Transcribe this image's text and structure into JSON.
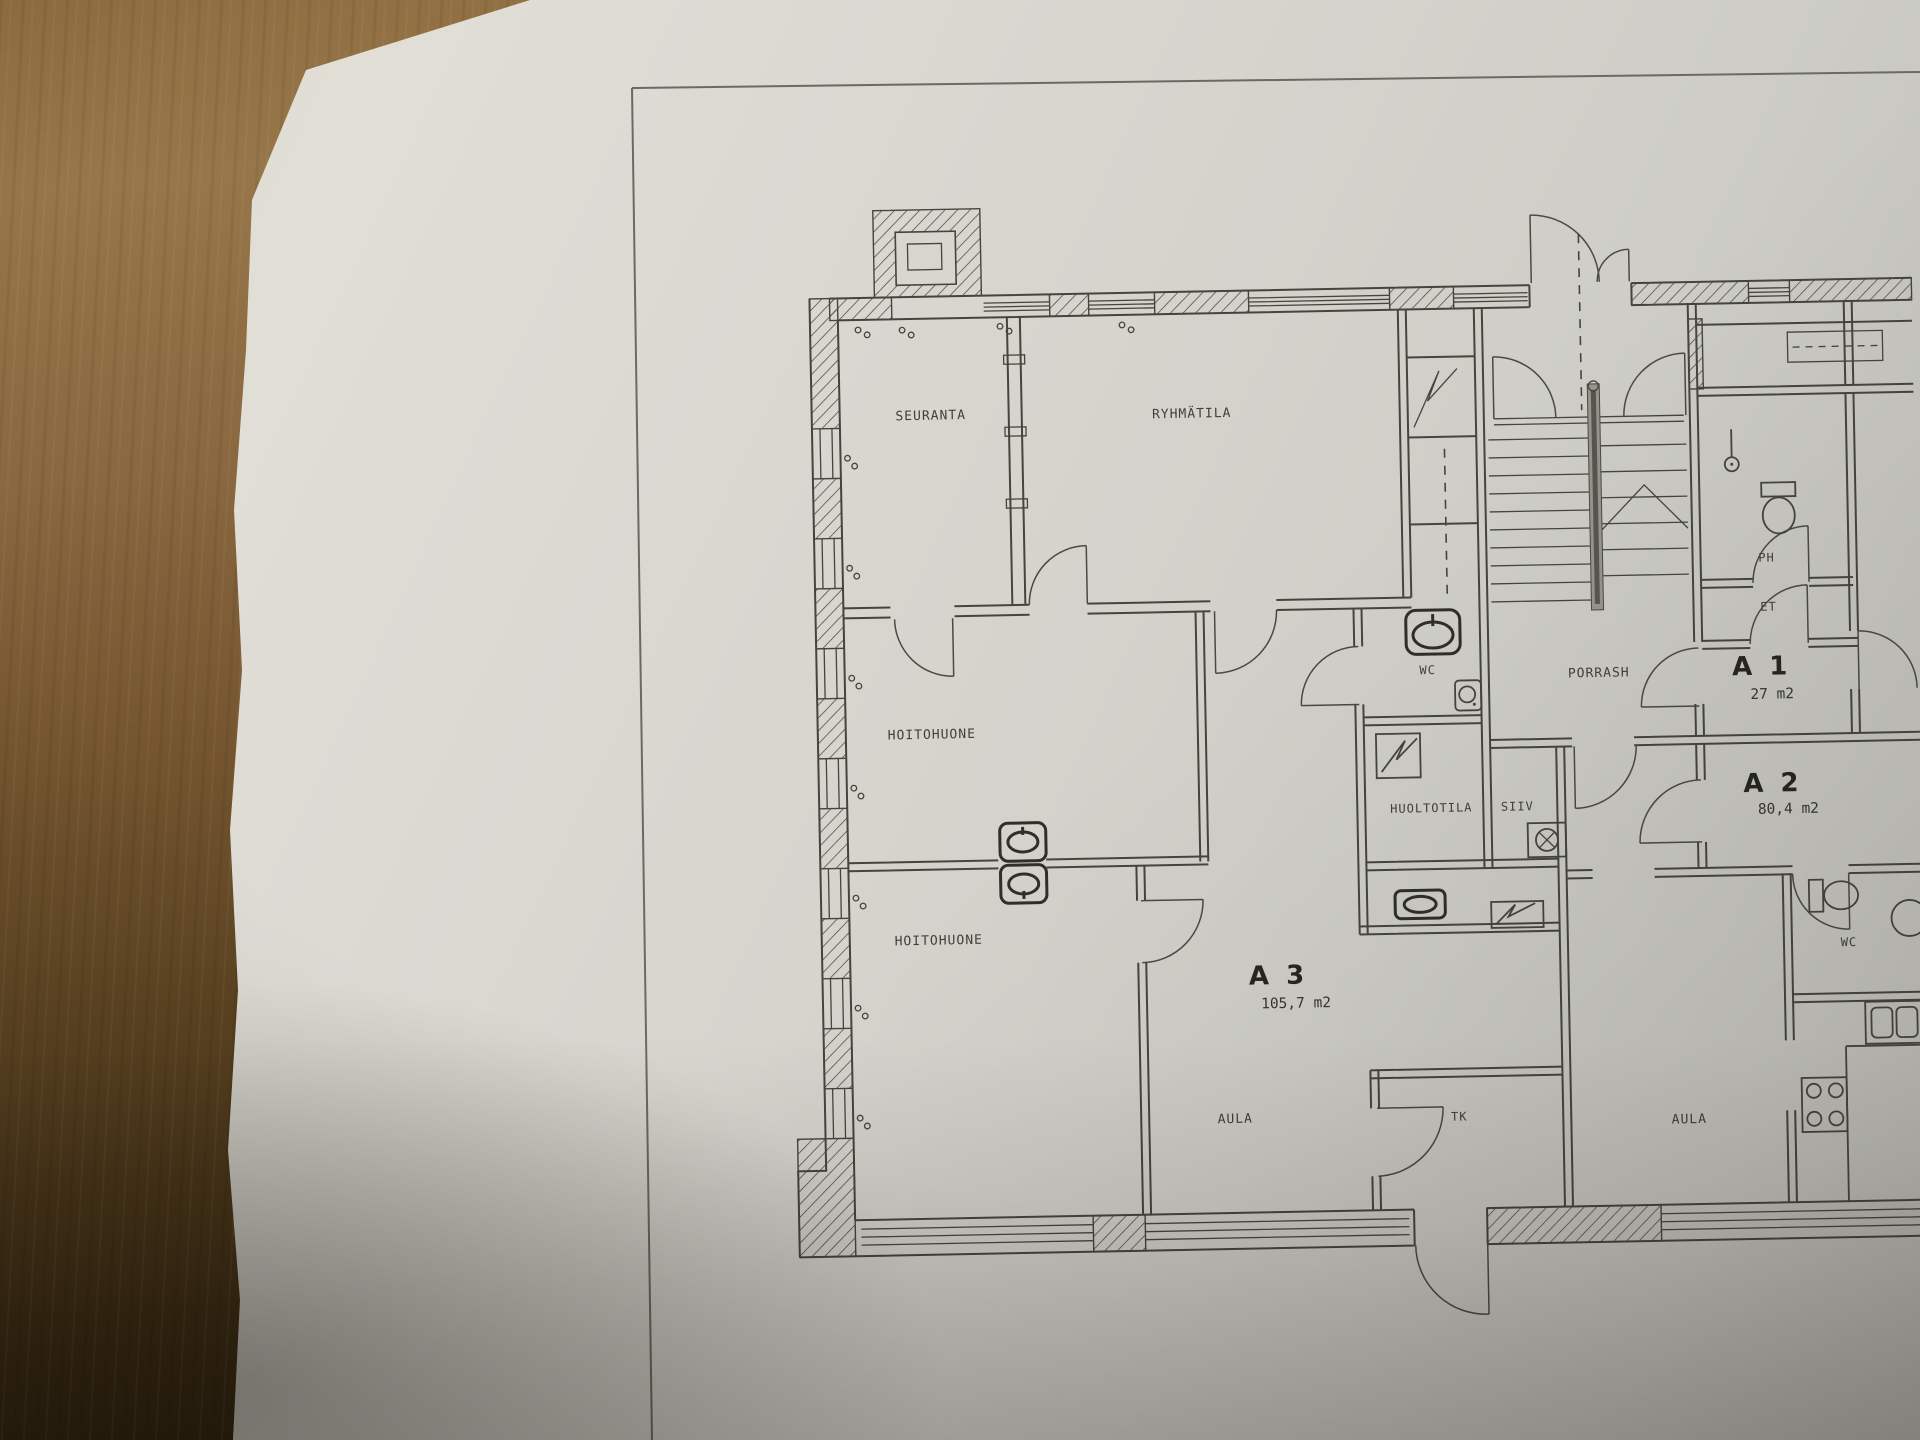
{
  "plan": {
    "rooms": [
      {
        "id": "seuranta",
        "label": "SEURANTA"
      },
      {
        "id": "ryhmatila",
        "label": "RYHMÄTILA"
      },
      {
        "id": "hoitohuone-1",
        "label": "HOITOHUONE"
      },
      {
        "id": "hoitohuone-2",
        "label": "HOITOHUONE"
      },
      {
        "id": "wc-a3",
        "label": "WC"
      },
      {
        "id": "huoltotila",
        "label": "HUOLTOTILA"
      },
      {
        "id": "siiv",
        "label": "SIIV"
      },
      {
        "id": "porrash",
        "label": "PORRASH"
      },
      {
        "id": "ph",
        "label": "PH"
      },
      {
        "id": "et",
        "label": "ET"
      },
      {
        "id": "aula-a3",
        "label": "AULA"
      },
      {
        "id": "tk",
        "label": "TK"
      },
      {
        "id": "aula-a2",
        "label": "AULA"
      },
      {
        "id": "wc-a2",
        "label": "WC"
      }
    ],
    "apartments": [
      {
        "id": "a1",
        "name": "A 1",
        "area": "27 m2"
      },
      {
        "id": "a2",
        "name": "A 2",
        "area": "80,4 m2"
      },
      {
        "id": "a3",
        "name": "A 3",
        "area": "105,7 m2"
      }
    ],
    "colors": {
      "paper": "#d7d5ce",
      "ink": "#45443d",
      "desk_wood": "#7c5c33"
    }
  }
}
